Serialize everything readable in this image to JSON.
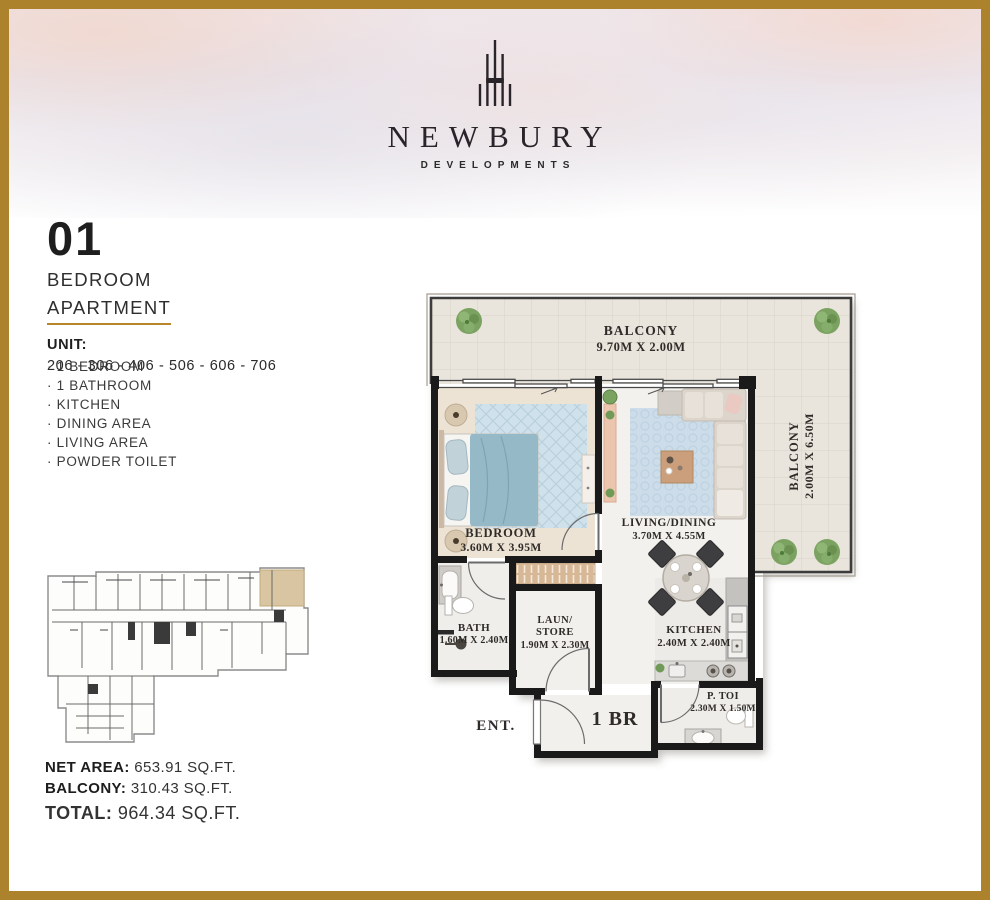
{
  "brand": {
    "name": "NEWBURY",
    "tagline": "DEVELOPMENTS"
  },
  "title": {
    "number": "01",
    "line1": "BEDROOM",
    "line2": "APARTMENT"
  },
  "unit": {
    "label": "UNIT:",
    "numbers": "206 - 306 - 406 - 506 - 606 - 706"
  },
  "features": [
    "· 1 BEDROOM",
    "· 1 BATHROOM",
    "· KITCHEN",
    "· DINING AREA",
    "· LIVING AREA",
    "· POWDER TOILET"
  ],
  "floorplan": {
    "balcony_top": {
      "name": "BALCONY",
      "dims": "9.70M X 2.00M"
    },
    "balcony_right": {
      "name": "BALCONY",
      "dims": "2.00M X 6.50M"
    },
    "bedroom": {
      "name": "BEDROOM",
      "dims": "3.60M X 3.95M"
    },
    "living": {
      "name": "LIVING/DINING",
      "dims": "3.70M X 4.55M"
    },
    "bath": {
      "name": "BATH",
      "dims": "1.60M X 2.40M"
    },
    "laundry": {
      "name_line1": "LAUN/",
      "name_line2": "STORE",
      "dims": "1.90M X 2.30M"
    },
    "kitchen": {
      "name": "KITCHEN",
      "dims": "2.40M X 2.40M"
    },
    "powder_toilet": {
      "name": "P. TOI",
      "dims": "2.30M X 1.50M"
    },
    "hall_label": "1 BR",
    "entrance_label": "ENT."
  },
  "areas": {
    "net": {
      "label": "NET AREA:",
      "value": "653.91 SQ.FT."
    },
    "balcony": {
      "label": "BALCONY:",
      "value": "310.43 SQ.FT."
    },
    "total": {
      "label": "TOTAL:",
      "value": "964.34 SQ.FT."
    }
  },
  "colors": {
    "gold": "#ac822d",
    "wall": "#1a1a1a",
    "highlight_unit": "#d9c5a1"
  }
}
